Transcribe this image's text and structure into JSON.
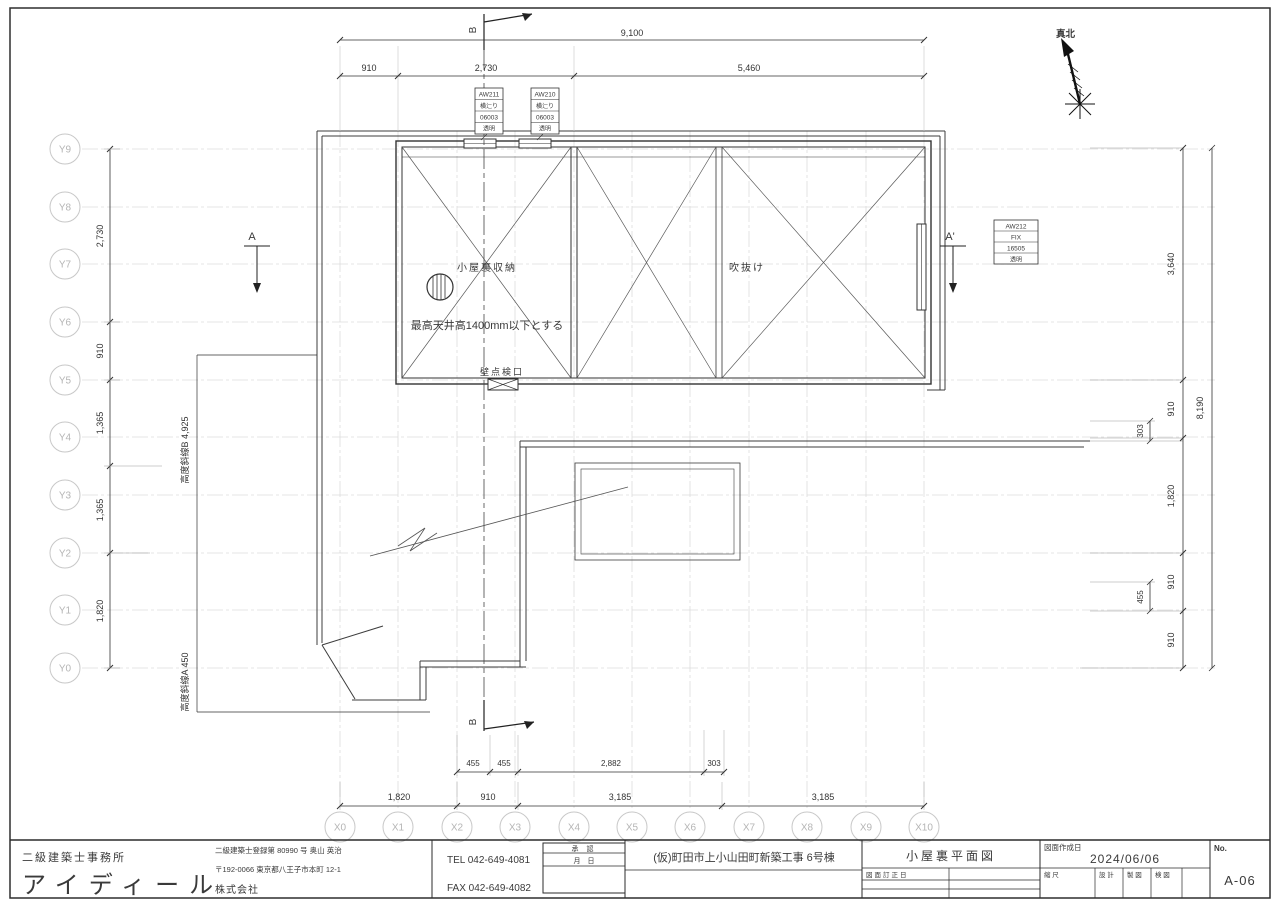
{
  "north_label": "真北",
  "grid": {
    "x_labels": [
      "X0",
      "X1",
      "X2",
      "X3",
      "X4",
      "X5",
      "X6",
      "X7",
      "X8",
      "X9",
      "X10"
    ],
    "y_labels": [
      "Y9",
      "Y8",
      "Y7",
      "Y6",
      "Y5",
      "Y4",
      "Y3",
      "Y2",
      "Y1",
      "Y0"
    ]
  },
  "dimensions": {
    "top_overall": "9,100",
    "top_segments": [
      "910",
      "2,730",
      "5,460"
    ],
    "left_segments": [
      "2,730",
      "910",
      "1,365",
      "1,365",
      "1,820"
    ],
    "right_segments": [
      "3,640",
      "910",
      "1,820",
      "910",
      "910"
    ],
    "right_overall": "8,190",
    "right_sub_upper": "303",
    "right_sub_lower": "455",
    "bottom_upper_segments": [
      "455",
      "455",
      "2,882",
      "303"
    ],
    "bottom_lower_segments": [
      "1,820",
      "910",
      "3,185",
      "3,185"
    ]
  },
  "plan": {
    "attic_room_label": "小屋裏収納",
    "void_label": "吹抜け",
    "ceiling_note": "最高天井高1400mm以下とする",
    "hatch_label": "壁点検口",
    "slant_b_label": "高度斜線B 4,925",
    "slant_a_label": "高度斜線A 450",
    "section_a": "A",
    "section_a_prime": "A'",
    "section_b_top": "B",
    "section_b_bottom": "B"
  },
  "window_tags": {
    "aw211": [
      "AW211",
      "横辷り",
      "06003",
      "透明"
    ],
    "aw210": [
      "AW210",
      "横辷り",
      "06003",
      "透明"
    ],
    "aw212": [
      "AW212",
      "FIX",
      "16505",
      "透明"
    ]
  },
  "titleblock": {
    "office_type": "二級建築士事務所",
    "company_name": "アイディール",
    "license_line": "二級建築士登録第 80990 号  奥山 英治",
    "address_line": "〒192-0066  東京都八王子市本町 12-1",
    "corp_label": "株式会社",
    "tel": "TEL 042-649-4081",
    "fax": "FAX 042-649-4082",
    "approval_label": "承 認",
    "month_day_label": "月　日",
    "project_name": "(仮)町田市上小山田町新築工事 6号棟",
    "drawing_title": "小屋裏平面図",
    "revision_label": "図面訂正日",
    "date_label": "図面作成日",
    "date_value": "2024/06/06",
    "scale_label": "縮 尺",
    "stamp_design": "設 計",
    "stamp_draft": "製 図",
    "stamp_check": "検 図",
    "no_label": "No.",
    "no_value": "A-06"
  }
}
